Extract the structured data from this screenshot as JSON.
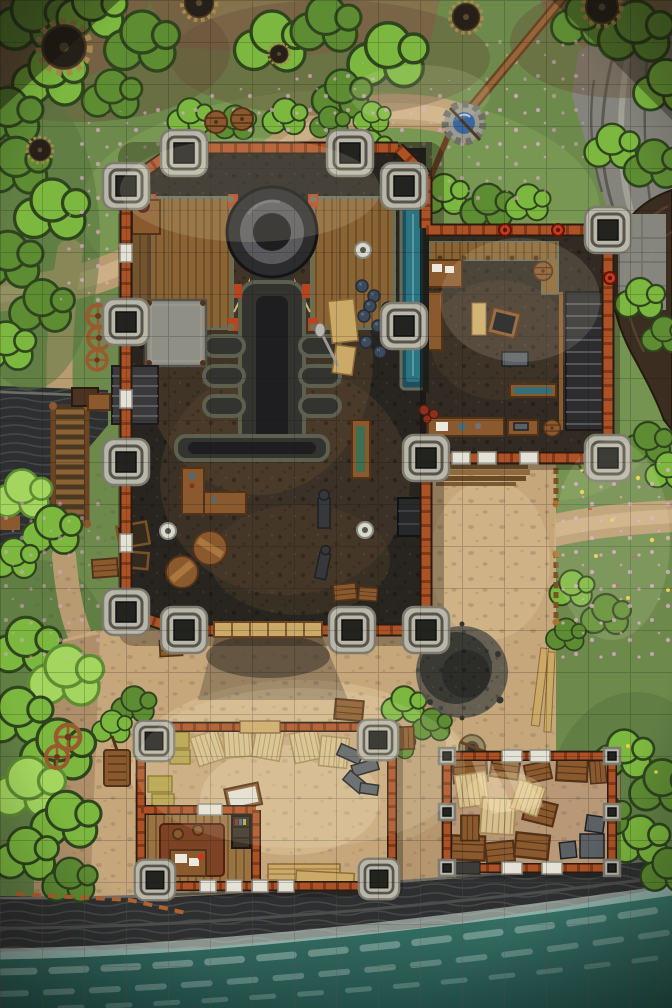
{
  "meta": {
    "scene": "Top-down fantasy battle map: a coastal foundry fortress with furnace hall, annex workshop, bunkhouse, warehouse, cherry-blossom woods, giant cogwheels, a well, sea cliffs and breaking surf",
    "grid": {
      "columns": 16,
      "rows": 24,
      "cell_px": 42
    }
  },
  "palette": {
    "grassBase": "#6d8a4c",
    "grassDk": "#56743d",
    "grassLt": "#86a65c",
    "grassGlow": "#b4cf82",
    "bushDk": "#2e451e",
    "bushMid": "#5e8c33",
    "bushLt": "#7cb83f",
    "bushPale": "#a4d65f",
    "petal": "#dfa9cb",
    "flower": "#eace4c",
    "dirt": "#8a6f4e",
    "dirtDk": "#66513a",
    "pathSand": "#b99b72",
    "pathLt": "#cfb389",
    "sand": "#c6a77c",
    "sandLt": "#dcc296",
    "sandSh": "#967757",
    "rock": "#84847c",
    "rockLt": "#a9a9a0",
    "rockLn": "#5a5a53",
    "cliff": "#2e2f30",
    "cliffLn": "#4c4d4c",
    "cliffHi": "#6d6e67",
    "seaLt": "#3b7a6e",
    "seaDk": "#234f49",
    "foam": "#d9e6df",
    "brick": "#ad5126",
    "brickDk": "#6e2f11",
    "wallOut": "#2a1c11",
    "win": "#e4e2d7",
    "winEdge": "#8e8c7f",
    "towerF": "#b9b7aa",
    "towerE": "#7d7b6f",
    "towerIn": "#56544b",
    "hole": "#232320",
    "floor": "#282520",
    "floorLt": "#473b2c",
    "rust": "#58432e",
    "annexF": "#322b23",
    "wood": "#8a5a2e",
    "woodDk": "#533217",
    "woodLt": "#b17c42",
    "plankPale": "#cbaa68",
    "scaff": "#8a6434",
    "rail": "#6d6d54",
    "rope": "#c9b873",
    "iron": "#36383b",
    "ironDk": "#1e2023",
    "metal": "#5b6065",
    "furnB": "#5a5a5e",
    "furnC": "#1e1e20",
    "ductRim": "#5d604f",
    "ductFill": "#33332f",
    "chan": "#2f7e8c",
    "chanDk": "#1d4f60",
    "ore": "#3d4a5a",
    "oreDk": "#232d39",
    "mat": "#d7c08f",
    "matLn": "#a58a55",
    "hay": "#b5a24d",
    "hayDk": "#847324",
    "rug": "#7c4326",
    "rugDk": "#531f10",
    "red": "#c23a20",
    "wellWater": "#3c66a0",
    "white": "#eceadf",
    "soot": "#403e38",
    "shade": "#17110a",
    "lume": "#fff6d6"
  },
  "features": {
    "outdoors": [
      "cherry-blossom trees",
      "flower meadow",
      "dirt paths",
      "giant cogwheels",
      "stone well with bucket beam",
      "rocky outcrop",
      "old tree trunk",
      "sea cliffs",
      "breaking surf",
      "wooden bridge",
      "timber fences",
      "wagon wheels",
      "hand carts",
      "supply crates",
      "rain barrels",
      "scorched blast mark",
      "campfire ring",
      "timber piles",
      "leaning planks"
    ],
    "foundry_hall": [
      "stone corner towers",
      "brick curtain walls",
      "white windows",
      "double timber gate",
      "great furnace with chimney",
      "exhaust manifold",
      "timber scaffolds",
      "water channel",
      "red shut-off valves",
      "loading platform",
      "staircase",
      "workbenches",
      "round tables",
      "anvils",
      "ore piles",
      "tool shelf",
      "column bases",
      "open crates"
    ],
    "annex_workshop": [
      "upper walkway",
      "staircase",
      "workbenches",
      "quenching trough",
      "ore crate",
      "barrels",
      "red coils"
    ],
    "bunkhouse": [
      "inner office",
      "desk with papers",
      "rug",
      "bookshelf",
      "hay bales",
      "woven mats",
      "white-topped table",
      "scrap metal heap",
      "plank stacks",
      "stools"
    ],
    "warehouse": [
      "crate stacks",
      "woven mats",
      "sunbeams through roof",
      "grey corner posts"
    ]
  }
}
